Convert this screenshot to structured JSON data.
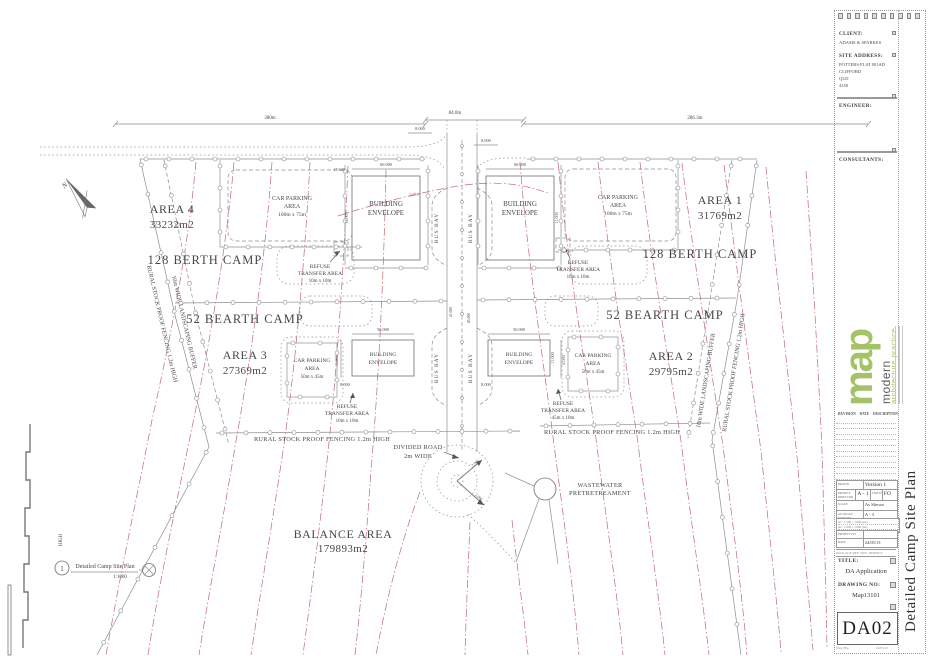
{
  "sheet": {
    "client_label": "CLIENT:",
    "client": "ADAMS & SPARKES",
    "site_address_label": "SITE ADDRESS:",
    "site_address": [
      "POTTERS FLAT ROAD",
      "CLIFFORD",
      "QLD",
      "4350"
    ],
    "engineer_label": "ENGINEER:",
    "consultants_label": "CONSULTANTS:",
    "logo": {
      "mark": "map",
      "word1": "modern",
      "word2": "architecture practice"
    },
    "revisions": {
      "rev": "REVISION",
      "date": "DATE",
      "desc": "DESCRIPTION"
    },
    "info": {
      "drawn_label": "DRAWN",
      "drawn": "Version 1",
      "director_label": "PROJECT DIRECTOR",
      "director": "A - 1",
      "status_label": "STATUS",
      "status": "FO",
      "scale_label": "SCALE",
      "scale": "As Shown",
      "print_label": "AUTOCAD PRINTING",
      "print": "A - 3",
      "micro_rows": [
        "A1 - 1:100 = 1.000 (A1)",
        "A2 - 1:200 = 1.000 (A2)",
        "A3 - 1:400 = 1.000 (A3)"
      ],
      "project_label": "PROJECT NO",
      "project": "",
      "date_label": "DATE",
      "date": "24/05/13",
      "package": "PACKAGE REF:   DOC PROJECT"
    },
    "title_label": "TITLE:",
    "title": "DA Application",
    "drawing_no_label": "DRAWING NO:",
    "drawing_no": "Map13101",
    "sheet_no": "DA02",
    "side_title": "Detailed Camp Site Plan",
    "footer_left": "Dwg File",
    "footer_right": "24/05/13",
    "accent_green": "#a4c266"
  },
  "plan": {
    "north": "N",
    "legend": {
      "num": "1",
      "title": "Detailed Camp Site Plan",
      "scale": "1:1000"
    },
    "dims": {
      "top_left": "380m",
      "top_mid": "84.0m",
      "top_right": "286.3m",
      "offset_a": "8.000",
      "offset_b": "8.000",
      "be_top_w": "60.000",
      "be_top_off": "17.600",
      "be_top_h": "11.005",
      "be_mid_w": "50.000",
      "be_mid_h": "11.000",
      "be_mid_off": "8.000",
      "be_mid_gap": "5.000",
      "rb_a": "2.000",
      "rb_b": "2.000",
      "road_a": "41.000",
      "road_b": "45.000"
    },
    "areas": [
      {
        "name": "AREA 1",
        "size": "31769m2"
      },
      {
        "name": "AREA 2",
        "size": "29795m2"
      },
      {
        "name": "AREA 3",
        "size": "27369m2"
      },
      {
        "name": "AREA 4",
        "size": "33232m2"
      }
    ],
    "camps": {
      "large": "128 BERTH CAMP",
      "small": "52 BEARTH CAMP"
    },
    "balance": {
      "name": "BALANCE AREA",
      "size": "179893m2"
    },
    "car_park_large": {
      "l1": "CAR PARKING",
      "l2": "AREA",
      "l3": "100m x 75m"
    },
    "car_park_small": {
      "l1": "CAR PARKING",
      "l2": "AREA",
      "l3": "50m x 45m"
    },
    "refuse_small": {
      "l1": "REFUSE",
      "l2": "TRANSFER AREA",
      "l3": "10m x 10m"
    },
    "refuse_wide": {
      "l1": "REFUSE",
      "l2": "TRANSFER AREA",
      "l3": "45m x 10m"
    },
    "building_envelope": {
      "l1": "BUILDING",
      "l2": "ENVELOPE"
    },
    "bus_bay": "BUS BAY",
    "fencing": "RURAL STOCK PROOF FENCING 1.2m HIGH",
    "buffer": "10m WIDE LANDSCAPING BUFFER",
    "fencing_partial": "HIGH",
    "divided_road": {
      "l1": "DIVIDED ROAD",
      "l2": "2m WIDE"
    },
    "wastewater": {
      "l1": "WASTEWATER",
      "l2": "PRETRETREAMENT"
    },
    "contour_label": "560m",
    "contour_color": "#c1696c"
  }
}
